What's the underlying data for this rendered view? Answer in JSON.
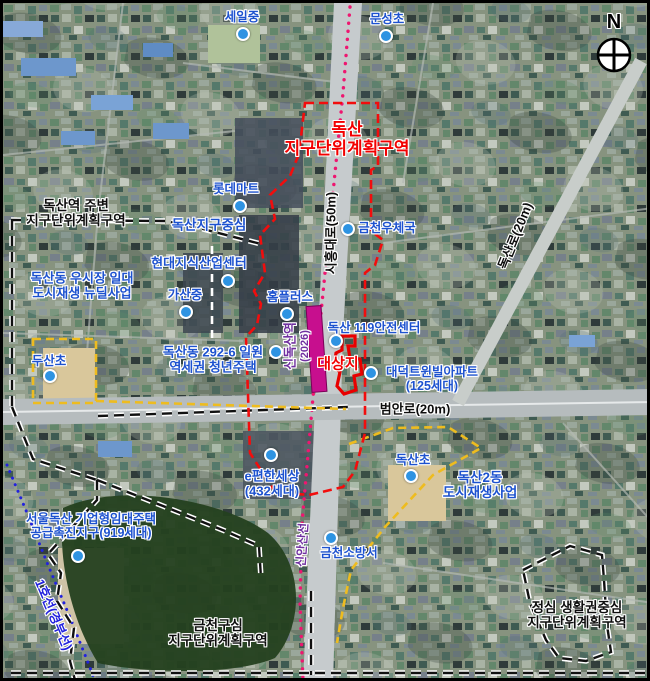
{
  "compass": {
    "n": "N"
  },
  "districts": {
    "doksan_line1": "독산",
    "doksan_line2": "지구단위계획구역",
    "vicinity_line1": "독산역 주변",
    "vicinity_line2": "지구단위계획구역",
    "district_center": "독산지구중심",
    "usijang_line1": "독산동 우시장 일대",
    "usijang_line2": "도시재생 뉴딜사업",
    "youth_line1": "독산동 292-6 일원",
    "youth_line2": "역세권 청년주택",
    "target_site": "대상지",
    "doksan2dong_line1": "독산2동",
    "doksan2dong_line2": "도시재생사업",
    "seouldoksan_line1": "서울독산 기업형임대주택",
    "seouldoksan_line2": "공급촉진지구(919세대)",
    "geumcheon_core_line1": "금천구심",
    "geumcheon_core_line2": "지구단위계획구역",
    "jeongsim_line1": "정심 생활권중심",
    "jeongsim_line2": "지구단위계획구역"
  },
  "pois": {
    "seil_middle": "세일중",
    "munseong_elem": "문성초",
    "lotte_mart": "롯데마트",
    "geumcheon_post": "금천우체국",
    "hyundai_center": "현대지식산업센터",
    "gasan_middle": "가산중",
    "home_plus": "홈플러스",
    "safety_119": "독산 119안전센터",
    "daedeok_line1": "대덕트윈빌아파트",
    "daedeok_line2": "(125세대)",
    "dusan_elem": "두산초",
    "epyeonhan_line1": "e편한세상",
    "epyeonhan_line2": "(432세대)",
    "doksan_elem": "독산초",
    "fire_station": "금천소방서"
  },
  "roads": {
    "siheung_daero": "시흥대로(50m)",
    "doksan_ro": "독산로(20m)",
    "beoman_ro": "범안로(20m)"
  },
  "transit": {
    "sin_doksan_station": "신독산역",
    "sin_doksan_year": "(2026)",
    "sin_ansan_line": "신안산선",
    "line1_gyeongbu": "1호선(경부선)"
  },
  "colors": {
    "label_blue": "#1d52cf",
    "marker_blue": "#2e93e2",
    "boundary_red": "#f20d0d",
    "station_magenta": "#c70f8e",
    "transit_purple": "#7030a0",
    "line1_blue": "#2222dd",
    "boundary_yellow": "#eebc1f"
  }
}
